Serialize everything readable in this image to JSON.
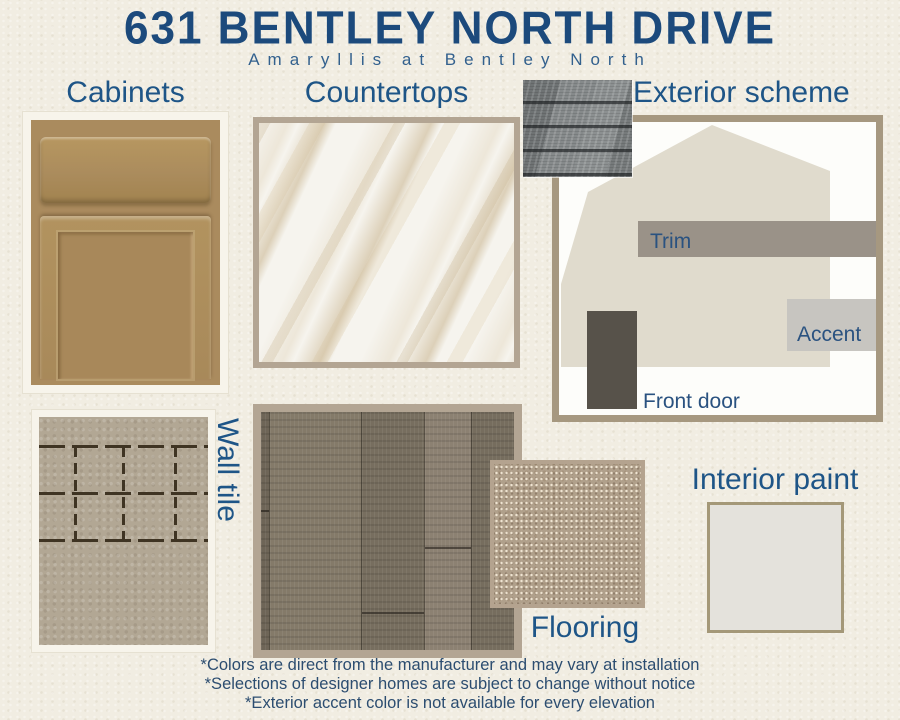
{
  "header": {
    "title": "631 BENTLEY NORTH DRIVE",
    "subtitle": "Amaryllis at Bentley North"
  },
  "sections": {
    "cabinets": {
      "label": "Cabinets"
    },
    "countertops": {
      "label": "Countertops"
    },
    "exterior": {
      "label": "Exterior scheme",
      "trim_label": "Trim",
      "accent_label": "Accent",
      "front_door_label": "Front door"
    },
    "wall_tile": {
      "label": "Wall tile"
    },
    "flooring": {
      "label": "Flooring"
    },
    "interior_paint": {
      "label": "Interior paint"
    }
  },
  "disclaimer": [
    "*Colors are direct from the manufacturer and may vary at installation",
    "*Selections of designer homes are subject to change without notice",
    "*Exterior accent color is not available for every elevation"
  ],
  "colors": {
    "background": "#f1ede2",
    "title_navy": "#1c4a7c",
    "label_blue": "#1e5587",
    "cabinet_wood": "#aa8b5e",
    "shingle_gray": "#868a8b",
    "house_body": "#e0dbcd",
    "trim_gray": "#9a9288",
    "accent_gray": "#c7c5c0",
    "front_door_brown": "#57524a",
    "wall_tile_taupe": "#b2a794",
    "grout_dark": "#3f3423",
    "carpet_beige": "#b0a08b",
    "interior_paint": "#e4e2dc",
    "frame_tan": "#b3a593",
    "frame_cream": "#f7f4eb"
  }
}
